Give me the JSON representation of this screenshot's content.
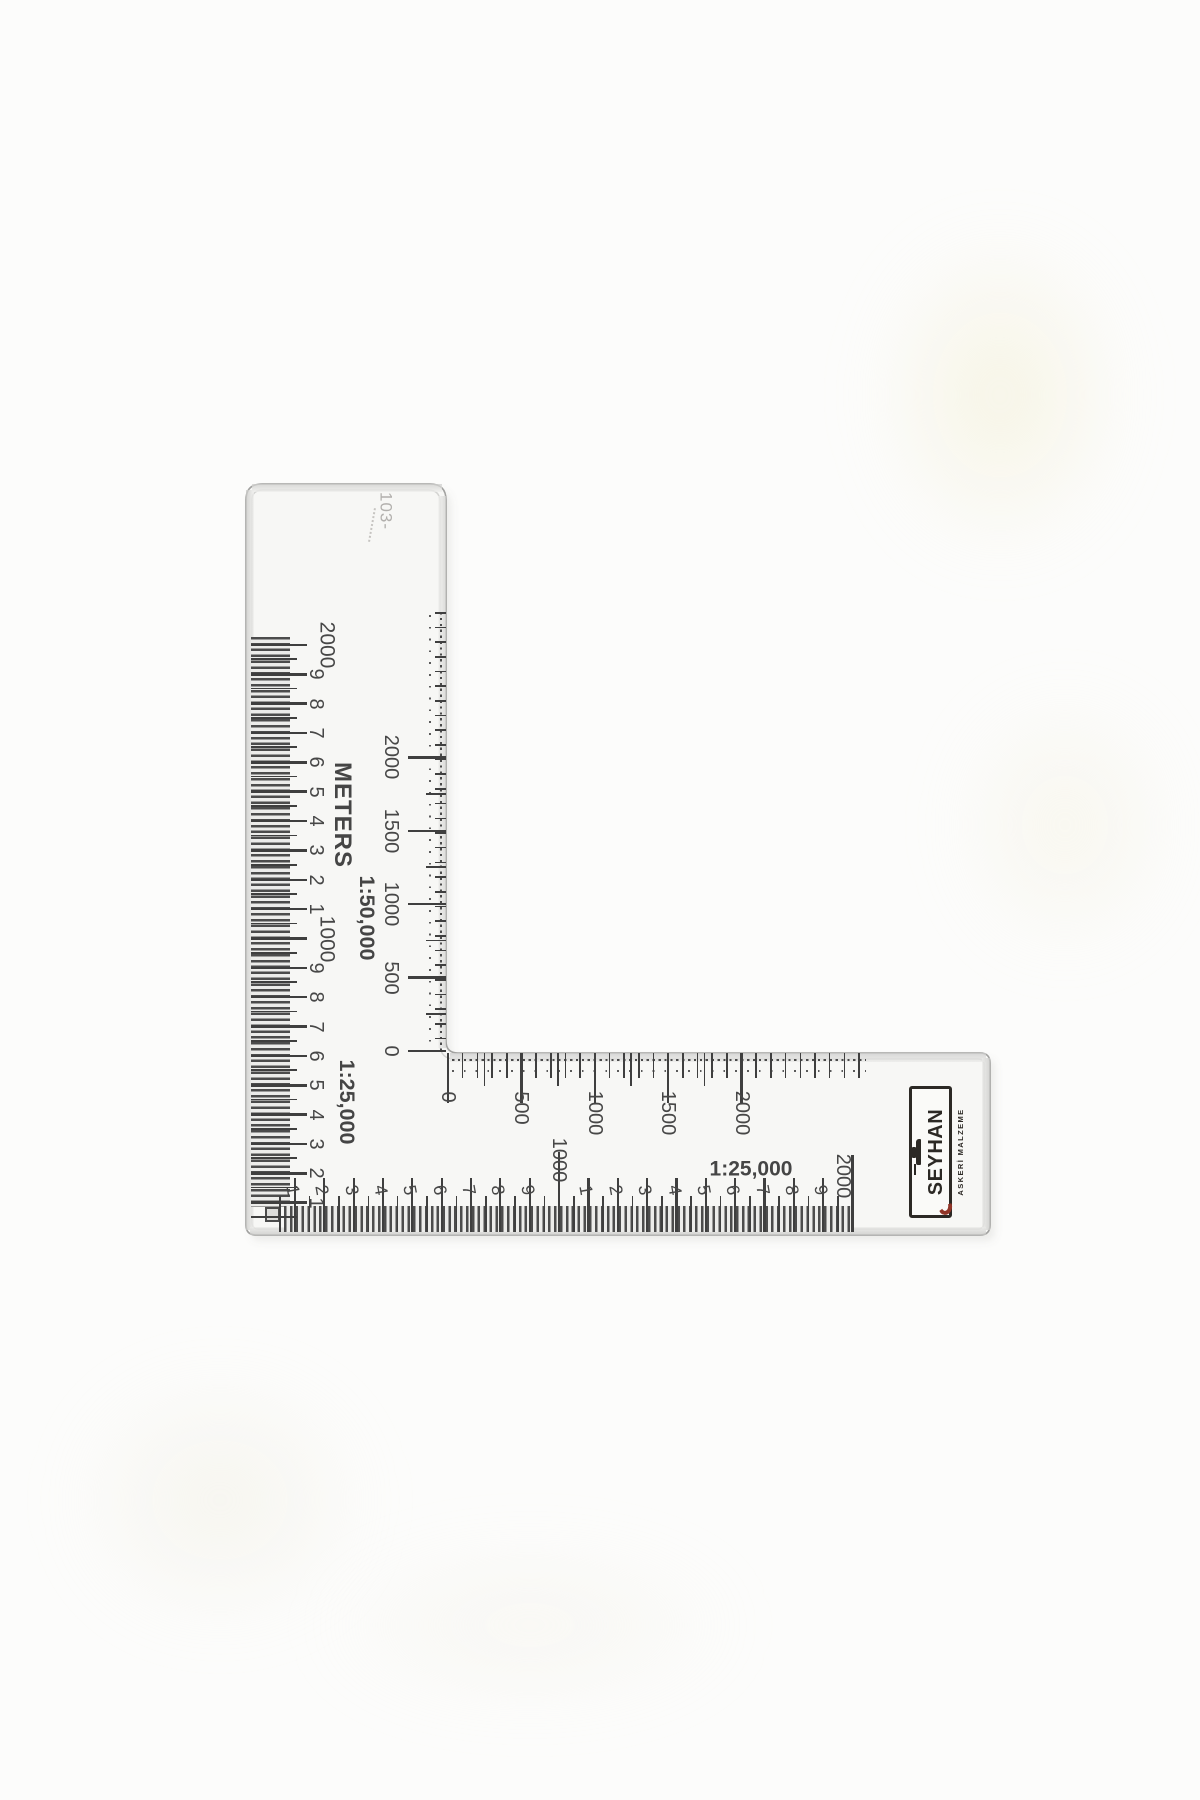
{
  "ruler": {
    "faint_code": "103-",
    "vertical_arm": {
      "left_scale_labels": [
        "2000",
        "9",
        "8",
        "7",
        "6",
        "5",
        "4",
        "3",
        "2",
        "1",
        "1000",
        "9",
        "8",
        "7",
        "6",
        "5",
        "4",
        "3",
        "2",
        "1"
      ],
      "meters_label": "METERS",
      "scale_50k": "1:50,000",
      "scale_25k": "1:25,000",
      "inner_scale_labels": [
        "2000",
        "1500",
        "1000",
        "500",
        "0"
      ]
    },
    "horizontal_arm": {
      "top_scale_labels": [
        "0",
        "500",
        "1000",
        "1500",
        "2000"
      ],
      "scale_25k": "1:25,000",
      "bottom_scale_labels": [
        "1",
        "2",
        "3",
        "4",
        "5",
        "6",
        "7",
        "8",
        "9",
        "1000",
        "1",
        "2",
        "3",
        "4",
        "5",
        "6",
        "7",
        "8",
        "9"
      ],
      "bottom_end_label": "2000"
    },
    "logo": {
      "brand": "SEYHAN",
      "subtitle": "ASKERİ MALZEME"
    }
  },
  "colors": {
    "background": "#fcfcfb",
    "body": "#f7f7f5",
    "edge": "#a2a2a0",
    "bevel": "#d4d4d2",
    "tick": "#3f3f3f",
    "label": "#474747",
    "faint": "#b2b0ad",
    "logo_black": "#221e1a",
    "logo_red": "#8c2b1e"
  }
}
